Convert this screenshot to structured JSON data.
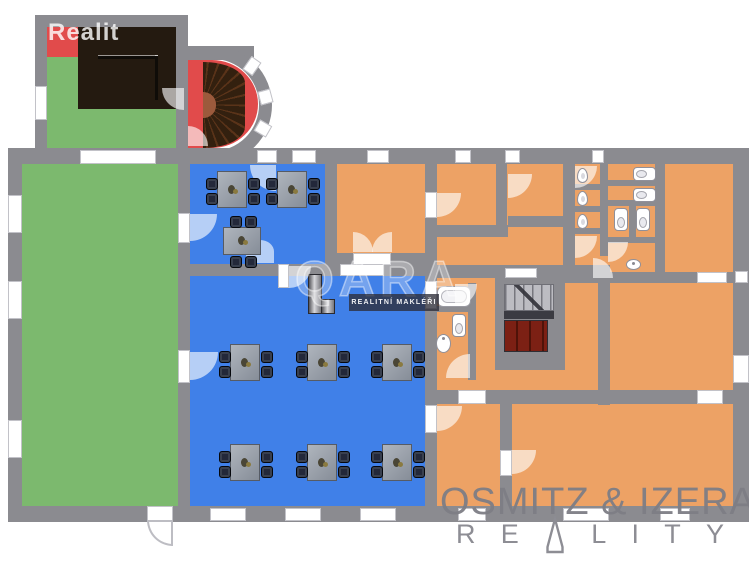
{
  "watermarks": {
    "top_left": "Realit",
    "center_brand": "QARA",
    "center_tagline": "REALITNÍ MAKLÉŘI",
    "bottom_brand": "OSMITZ & IZERA",
    "reality_letters": [
      "R",
      "E",
      "A",
      "L",
      "I",
      "T",
      "Y"
    ]
  },
  "colors": {
    "wall": "#8b8b90",
    "green": "#7cb96e",
    "blue": "#4080e8",
    "orange": "#eda265",
    "red": "#e14b4b",
    "terrace": "#241a10",
    "steps": "#bcbcc2",
    "wood": "#7c2014",
    "table": "#9aa1ab",
    "chair": "#23283a",
    "window": "#ffffff",
    "logo_gray": "#8d8d94",
    "page_bg": "#ffffff"
  },
  "floor_plan": {
    "rooms": [
      {
        "name": "garden-room-left",
        "color": "green"
      },
      {
        "name": "small-dining-room",
        "color": "blue",
        "tables": 3
      },
      {
        "name": "main-dining-hall",
        "color": "blue",
        "tables": 6
      },
      {
        "name": "terrace-deck",
        "color": "terrace"
      },
      {
        "name": "spiral-stair-room",
        "color": "red"
      },
      {
        "name": "orange-rooms-wing",
        "color": "orange"
      },
      {
        "name": "sanitary-block",
        "color": "orange",
        "toilets": 5,
        "urinals": 3,
        "sinks": 2,
        "bathtubs": 1
      }
    ],
    "windows": [
      [
        257,
        150,
        20,
        13
      ],
      [
        292,
        150,
        24,
        13
      ],
      [
        367,
        150,
        22,
        13
      ],
      [
        455,
        150,
        16,
        13
      ],
      [
        505,
        150,
        15,
        13
      ],
      [
        592,
        150,
        12,
        13
      ],
      [
        80,
        150,
        76,
        14
      ],
      [
        8,
        195,
        14,
        38
      ],
      [
        8,
        281,
        14,
        38
      ],
      [
        8,
        420,
        14,
        38
      ],
      [
        733,
        355,
        16,
        28
      ],
      [
        735,
        271,
        13,
        12
      ],
      [
        210,
        508,
        36,
        13
      ],
      [
        285,
        508,
        36,
        13
      ],
      [
        360,
        508,
        36,
        13
      ],
      [
        458,
        508,
        28,
        13
      ],
      [
        563,
        508,
        46,
        13
      ],
      [
        660,
        508,
        30,
        13
      ],
      [
        340,
        264,
        44,
        12
      ],
      [
        35,
        86,
        12,
        34
      ],
      [
        178,
        213,
        12,
        30
      ],
      [
        178,
        350,
        12,
        33
      ],
      [
        425,
        192,
        12,
        26
      ],
      [
        425,
        281,
        12,
        28
      ],
      [
        425,
        405,
        12,
        28
      ],
      [
        353,
        253,
        38,
        12
      ],
      [
        500,
        450,
        12,
        26
      ],
      [
        147,
        506,
        26,
        16
      ],
      [
        278,
        264,
        11,
        24
      ],
      [
        458,
        390,
        28,
        14
      ],
      [
        697,
        390,
        26,
        14
      ],
      [
        697,
        272,
        30,
        11
      ],
      [
        505,
        268,
        32,
        10
      ],
      [
        244,
        60,
        16,
        12,
        -55
      ],
      [
        259,
        90,
        13,
        14,
        -15
      ],
      [
        256,
        122,
        14,
        13,
        30
      ]
    ],
    "door_arcs": [
      [
        250,
        165,
        26,
        "tr"
      ],
      [
        190,
        214,
        27,
        "tl"
      ],
      [
        289,
        266,
        22,
        "tl"
      ],
      [
        190,
        352,
        28,
        "tl"
      ],
      [
        246,
        240,
        28,
        "up"
      ],
      [
        437,
        406,
        25,
        "tl"
      ],
      [
        353,
        232,
        20,
        "bl"
      ],
      [
        372,
        232,
        20,
        "br"
      ],
      [
        437,
        193,
        24,
        "tl"
      ],
      [
        508,
        174,
        24,
        "tl"
      ],
      [
        575,
        166,
        22,
        "tl"
      ],
      [
        575,
        236,
        22,
        "tl"
      ],
      [
        608,
        242,
        20,
        "tl"
      ],
      [
        593,
        258,
        20,
        "bl"
      ],
      [
        455,
        284,
        22,
        "tl"
      ],
      [
        446,
        354,
        24,
        "br"
      ],
      [
        512,
        450,
        24,
        "tl"
      ],
      [
        162,
        88,
        22,
        "tr"
      ],
      [
        188,
        126,
        20,
        "bl"
      ],
      [
        147,
        520,
        26,
        "tr",
        "ext"
      ]
    ],
    "tables": {
      "vertical": [
        [
          217,
          171
        ],
        [
          277,
          171
        ],
        [
          230,
          344
        ],
        [
          307,
          344
        ],
        [
          382,
          344
        ],
        [
          230,
          444
        ],
        [
          307,
          444
        ],
        [
          382,
          444
        ]
      ],
      "horizontal": [
        [
          223,
          227
        ]
      ]
    },
    "toilets": [
      [
        452,
        314,
        "v"
      ],
      [
        633,
        167,
        "h"
      ],
      [
        633,
        188,
        "h"
      ],
      [
        614,
        208,
        "v"
      ],
      [
        636,
        208,
        "v"
      ]
    ],
    "urinals": [
      [
        577,
        168
      ],
      [
        577,
        191
      ],
      [
        577,
        214
      ]
    ],
    "sinks": [
      [
        436,
        334,
        15,
        19
      ],
      [
        626,
        259,
        15,
        11
      ]
    ]
  }
}
